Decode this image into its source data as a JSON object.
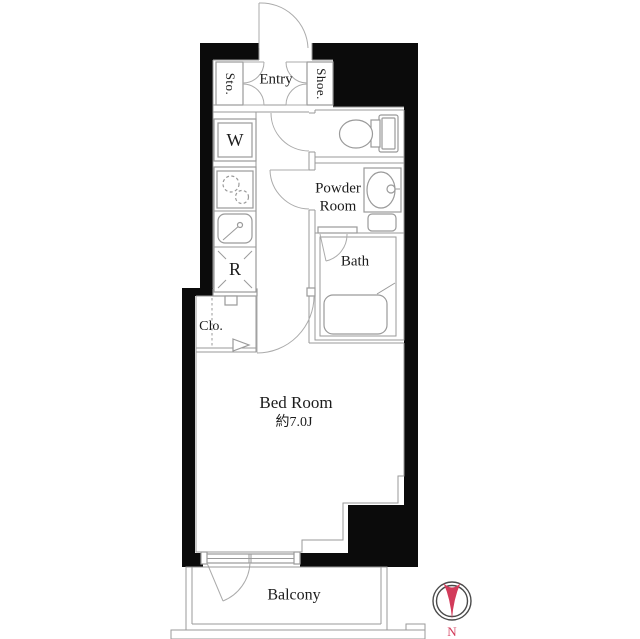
{
  "plan": {
    "type": "apartment-floor-plan",
    "rooms": {
      "entry": "Entry",
      "storage": "Sto.",
      "shoe_box": "Shoe.",
      "washer": "W",
      "powder_line1": "Powder",
      "powder_line2": "Room",
      "bath": "Bath",
      "refrigerator": "R",
      "closet": "Clo.",
      "bedroom": "Bed Room",
      "bedroom_size": "約7.0J",
      "balcony": "Balcony"
    },
    "compass": {
      "north_label": "N"
    },
    "colors": {
      "wall": "#0b0b0b",
      "line": "#9a9a9a",
      "text": "#1c1c1c",
      "compass_red": "#d23b5a",
      "background": "#ffffff"
    }
  }
}
